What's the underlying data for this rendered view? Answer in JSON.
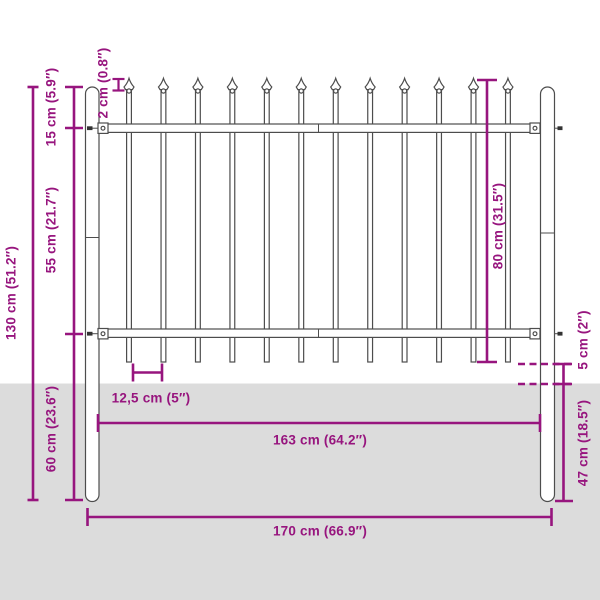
{
  "diagram": {
    "type": "product-dimension-diagram",
    "subject": "steel garden fence panel with spear top and two round posts, partially buried in ground",
    "colors": {
      "annotation": "#97157e",
      "ground": "#dcdcdc",
      "fence_outline": "#4d4d4d",
      "background": "#ffffff"
    },
    "fence": {
      "picket_count": 12,
      "post_count": 2,
      "rail_count": 2
    },
    "labels": {
      "total_height": "130 cm (51.2″)",
      "top_offset": "15 cm (5.9″)",
      "spear_head": "2 cm (0.8″)",
      "rail_gap": "55 cm (21.7″)",
      "below_rail": "60 cm (23.6″)",
      "panel_height": "80 cm (31.5″)",
      "picket_spacing": "12,5 cm (5″)",
      "ground_gap": "5 cm (2″)",
      "underground": "47 cm (18.5″)",
      "panel_width": "163 cm (64.2″)",
      "total_width": "170 cm (66.9″)"
    }
  }
}
